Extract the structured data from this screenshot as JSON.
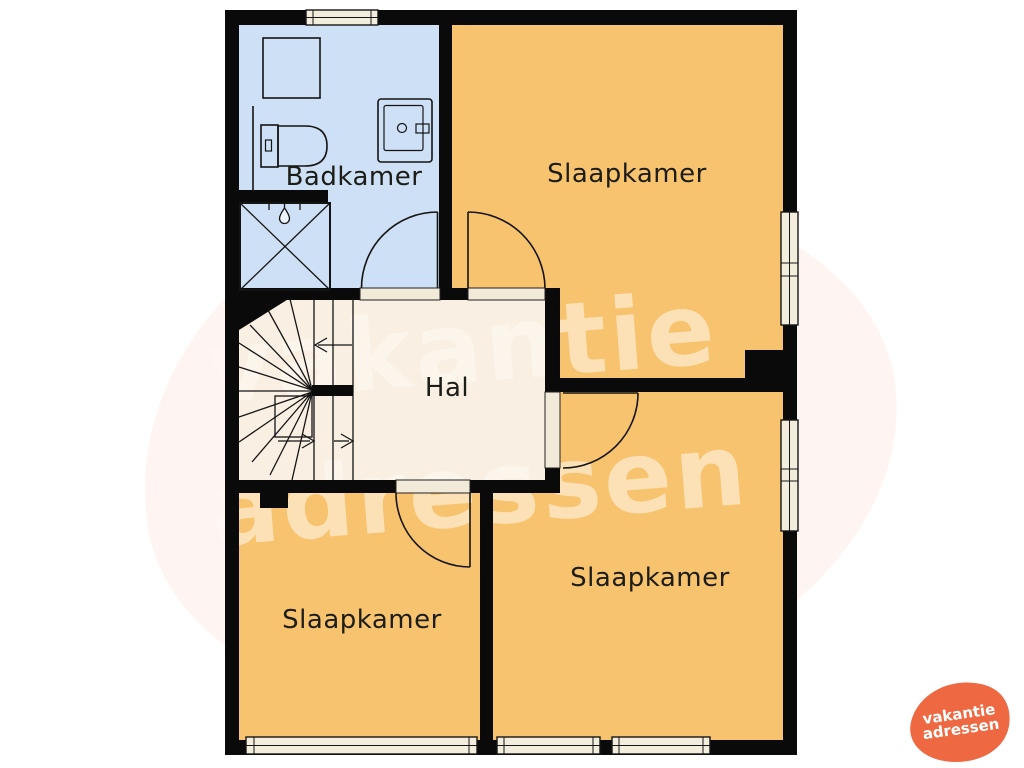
{
  "rooms": {
    "badkamer": {
      "label": "Badkamer"
    },
    "slaapkamer_top": {
      "label": "Slaapkamer"
    },
    "hal": {
      "label": "Hal"
    },
    "slaapkamer_rechts": {
      "label": "Slaapkamer"
    },
    "slaapkamer_links": {
      "label": "Slaapkamer"
    }
  },
  "watermark": {
    "line1": "vakantie",
    "line2": "adressen"
  },
  "logo": {
    "line1": "vakantie",
    "line2": "adressen"
  },
  "colors": {
    "wall": "#0a0a0a",
    "bedroom": "#f8c36e",
    "bathroom": "#cde0f5",
    "hall": "#f9f0e3",
    "window": "#f2eddc",
    "door_sill": "#f1ead8",
    "logo_orange": "#ee6941"
  }
}
